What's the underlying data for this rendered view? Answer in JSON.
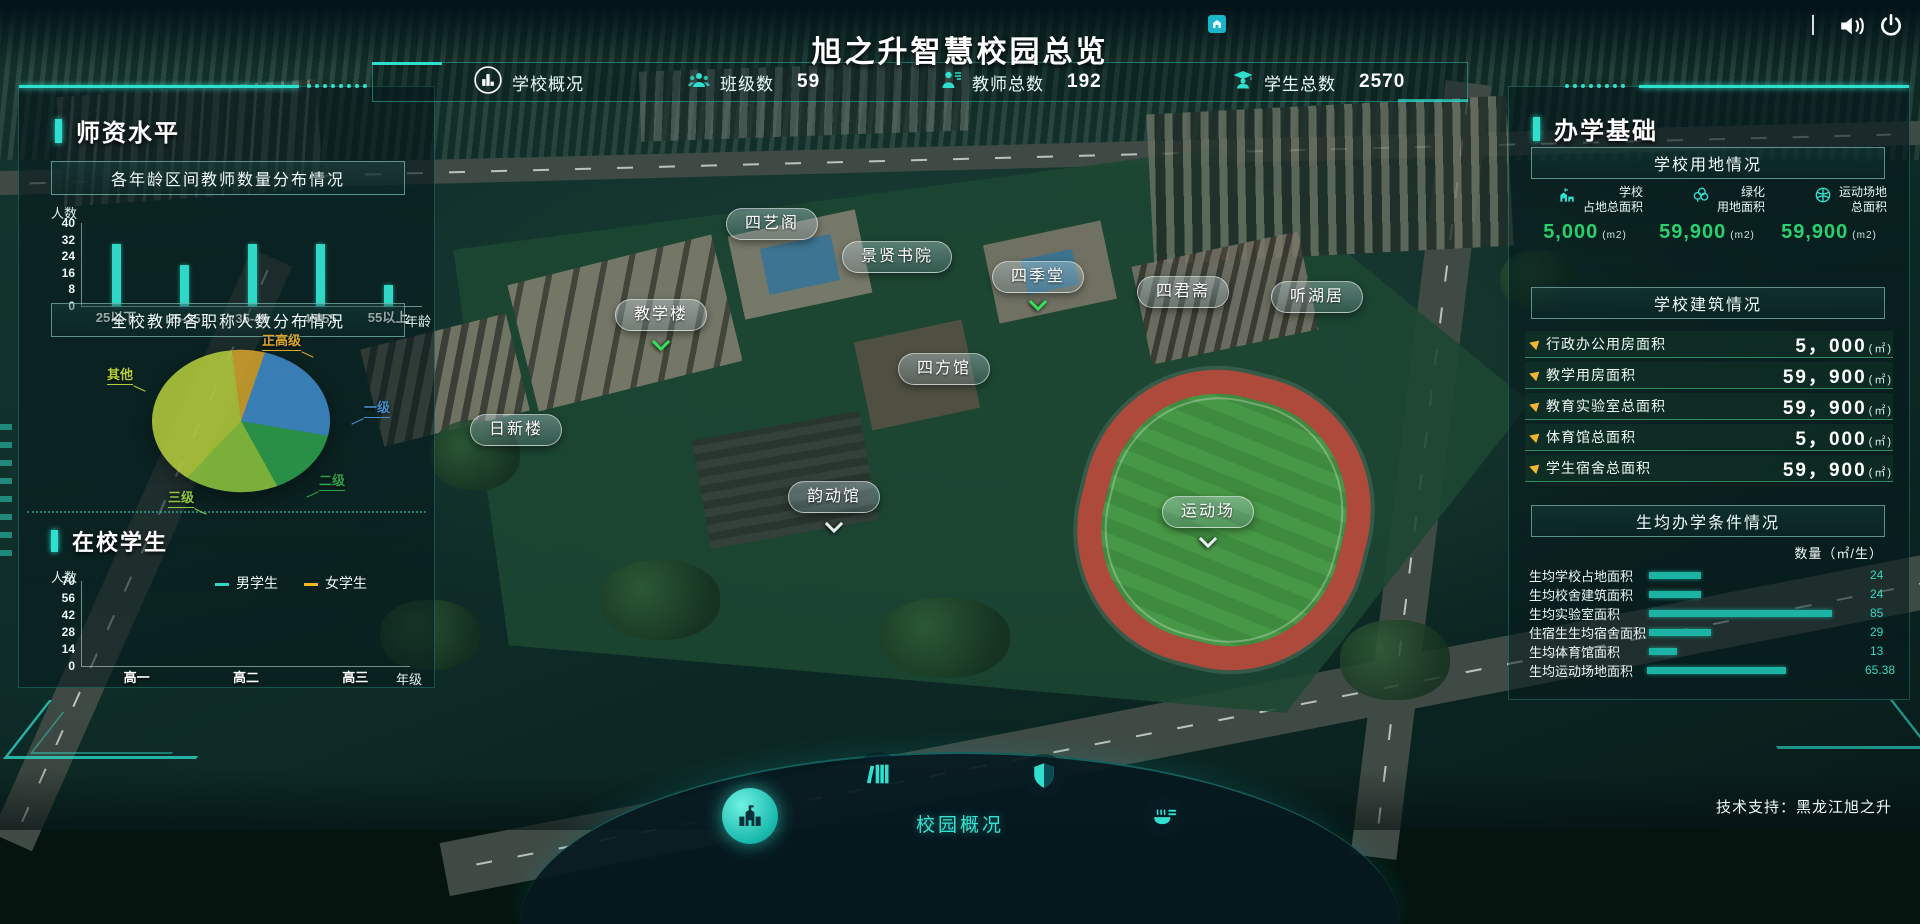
{
  "header": {
    "title": "旭之升智慧校园总览",
    "tech_support": "技术支持：黑龙江旭之升"
  },
  "stats_bar": {
    "overview_label": "学校概况",
    "items": [
      {
        "icon": "class-group-icon",
        "label": "班级数",
        "value": "59"
      },
      {
        "icon": "teacher-icon",
        "label": "教师总数",
        "value": "192"
      },
      {
        "icon": "student-icon",
        "label": "学生总数",
        "value": "2570"
      }
    ]
  },
  "left_panel": {
    "section1_title": "师资水平",
    "section2_title": "在校学生"
  },
  "right_panel": {
    "title": "办学基础",
    "land_title": "学校用地情况",
    "land_stats": [
      {
        "icon": "school-area-icon",
        "line1": "学校",
        "line2": "占地总面积",
        "value": "5,000",
        "unit": "(m2)"
      },
      {
        "icon": "greening-icon",
        "line1": "绿化",
        "line2": "用地面积",
        "value": "59,900",
        "unit": "(m2)"
      },
      {
        "icon": "sports-ground-icon",
        "line1": "运动场地",
        "line2": "总面积",
        "value": "59,900",
        "unit": "(m2)"
      }
    ],
    "building_title": "学校建筑情况",
    "building_rows": [
      {
        "label": "行政办公用房面积",
        "value": "5，000",
        "unit": "(㎡)"
      },
      {
        "label": "教学用房面积",
        "value": "59，900",
        "unit": "(㎡)"
      },
      {
        "label": "教育实验室总面积",
        "value": "59，900",
        "unit": "(㎡)"
      },
      {
        "label": "体育馆总面积",
        "value": "5，000",
        "unit": "(㎡)"
      },
      {
        "label": "学生宿舍总面积",
        "value": "59，900",
        "unit": "(㎡)"
      }
    ]
  },
  "map_labels": [
    {
      "text": "四艺阁"
    },
    {
      "text": "景贤书院"
    },
    {
      "text": "四季堂"
    },
    {
      "text": "四君斋"
    },
    {
      "text": "听湖居"
    },
    {
      "text": "教学楼"
    },
    {
      "text": "四方馆"
    },
    {
      "text": "日新楼"
    },
    {
      "text": "韵动馆"
    },
    {
      "text": "运动场"
    }
  ],
  "bottom_nav": {
    "label": "校园概况",
    "items": [
      "campus-overview-icon",
      "library-icon",
      "security-icon",
      "canteen-icon"
    ]
  },
  "chart_data": [
    {
      "id": "teacher_age",
      "type": "bar",
      "title": "各年龄区间教师数量分布情况",
      "ylabel": "人数",
      "xlabel": "年龄",
      "yticks": [
        0,
        8,
        16,
        24,
        32,
        40
      ],
      "ylim": [
        0,
        40
      ],
      "categories": [
        "25以下",
        "25-35",
        "35-45",
        "45-55",
        "55以上"
      ],
      "values": [
        30,
        20,
        30,
        30,
        10
      ],
      "bar_color": "#2fd8c6",
      "legend_position": "none",
      "grid": false
    },
    {
      "id": "teacher_rank",
      "type": "pie",
      "title": "全校教师各职称人数分布情况",
      "slices": [
        {
          "label": "正高级",
          "value": 6,
          "color": "#d9a62e"
        },
        {
          "label": "一级",
          "value": 24,
          "color": "#418fce"
        },
        {
          "label": "二级",
          "value": 15,
          "color": "#2fa14d"
        },
        {
          "label": "三级",
          "value": 17,
          "color": "#90c83e"
        },
        {
          "label": "其他",
          "value": 38,
          "color": "#b7d03c"
        }
      ]
    },
    {
      "id": "students",
      "type": "bar",
      "subtype": "stacked",
      "title": "在校学生",
      "ylabel": "人数",
      "xlabel": "年级",
      "yticks": [
        0,
        14,
        28,
        42,
        56,
        70
      ],
      "ylim": [
        0,
        70
      ],
      "categories": [
        "高一",
        "高二",
        "高三"
      ],
      "series": [
        {
          "name": "女学生",
          "color": "#f5b81c",
          "values": [
            30,
            21,
            30
          ]
        },
        {
          "name": "男学生",
          "color": "#2fd8c6",
          "values": [
            39,
            34,
            30
          ]
        }
      ],
      "legend_position": "top",
      "grid": false
    },
    {
      "id": "per_student",
      "type": "bar",
      "subtype": "horizontal",
      "title": "生均办学条件情况",
      "unit_label": "数量（㎡/生）",
      "categories": [
        "生均学校占地面积",
        "生均校舍建筑面积",
        "生均实验室面积",
        "住宿生生均宿舍面积",
        "生均体育馆面积",
        "生均运动场地面积"
      ],
      "values": [
        24,
        24,
        85,
        29,
        13,
        65.38
      ],
      "xmax": 100,
      "bar_color": "#1db3a4"
    }
  ]
}
